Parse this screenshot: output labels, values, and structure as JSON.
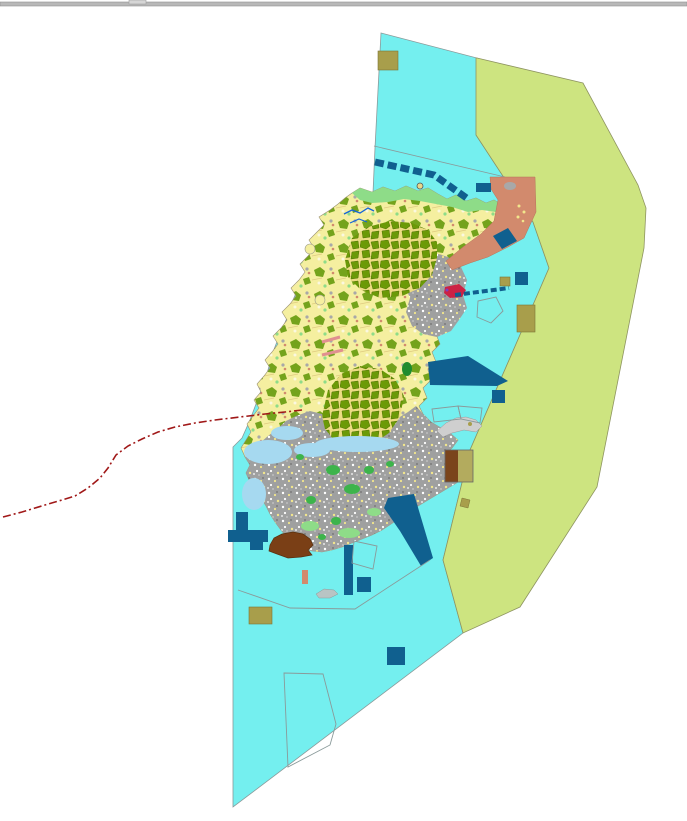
{
  "map": {
    "width": 687,
    "height": 821,
    "background": "#ffffff",
    "palette": {
      "bar": "#b8b8b8",
      "sea": "#74efef",
      "zone": "#cde480",
      "land": "#f5efa0",
      "forest": "#74a31c",
      "forest_dark": "#6b9a07",
      "forest_gap": "#ecdc82",
      "urban": "#9fa0a0",
      "salmon": "#d28a6d",
      "navy": "#10608f",
      "khaki": "#a89e4b",
      "khaki_light": "#b3ab5e",
      "brown": "#7a3f16",
      "brown_dark": "#7a441c",
      "green_light": "#8edc88",
      "green_bright": "#3db44b",
      "green_dark": "#1f8c2f",
      "wetland": "#a6d9f0",
      "redline": "#a01818",
      "river": "#1565d8",
      "outline": "#8a9a9a",
      "crimson": "#cc2244",
      "purple": "#7a3fbf",
      "pink": "#e09090",
      "gray_islet": "#cfcfcf",
      "ship": "#b9c4c4",
      "speck_white": "#fbf8e0",
      "speck_yellow": "#f2e68c",
      "speck_gray": "#a8a8a8"
    },
    "features": [
      {
        "name": "window-top-bar",
        "kind": "rect",
        "x": 0,
        "y": 2,
        "w": 687,
        "h": 4,
        "fill": "bar",
        "stroke": "#8f8f8f",
        "sw": 0.6
      },
      {
        "name": "window-top-bar-notch",
        "kind": "rect",
        "x": 129,
        "y": 0,
        "w": 17,
        "h": 4,
        "fill": "#d6d6d6",
        "stroke": "#9f9f9f",
        "sw": 0.6
      },
      {
        "name": "sea-area",
        "kind": "polygon",
        "pts": "381,33 477,58 476,135 516,196 533,222 549,268 470,450 443,560 463,633 233,807 233,447 242,438 250,420 256,404 262,388 268,370 273,352 280,334 287,318 293,300 300,284 308,268 315,252 322,238 330,224 340,212 352,202 364,196 373,193 375,148",
        "fill": "sea",
        "stroke": "outline",
        "sw": 0.8
      },
      {
        "name": "buffer-zone-area",
        "kind": "polygon",
        "pts": "477,58 583,83 638,185 646,208 644,248 597,487 520,607 463,633 443,560 470,450 549,268 533,222 516,196 476,135 476,58",
        "fill": "zone",
        "stroke": "#8e9460",
        "sw": 0.8
      },
      {
        "name": "sea-boundary-line",
        "kind": "polyline",
        "pts": "374,146 505,177",
        "stroke": "outline",
        "sw": 0.8
      },
      {
        "name": "island-landmass",
        "kind": "polygon",
        "pts": "352,193 360,188 372,192 383,187 395,191 406,186 418,191 428,188 438,194 447,199 456,195 466,201 476,198 486,203 494,200 502,205 510,202 515,208 506,216 496,224 486,231 476,239 466,247 457,256 450,264 455,272 448,280 452,290 444,298 448,308 440,316 444,326 436,334 440,344 432,352 436,362 428,370 431,380 423,388 427,398 419,406 423,414 431,422 441,428 451,434 458,440 452,448 445,454 451,462 461,468 466,474 458,482 448,488 438,494 428,500 418,506 408,512 400,518 391,524 382,530 372,535 362,539 352,543 342,547 332,550 322,552 312,551 302,548 294,543 287,537 281,530 275,522 270,514 266,506 261,498 255,490 250,482 246,473 250,465 245,457 241,448 246,440 251,432 247,424 253,416 259,408 254,400 261,392 257,384 264,376 270,368 265,360 272,352 278,344 273,336 281,328 287,320 282,312 290,304 296,296 291,288 299,280 305,272 300,264 308,256 314,248 309,240 317,232 324,225 319,217 330,210 338,204 345,198",
        "fill": "pattern:sparse",
        "stroke": "#9a9070",
        "sw": 0.6
      },
      {
        "name": "coastal-promontory-north",
        "kind": "circle",
        "cx": 310,
        "cy": 249,
        "r": 5,
        "fill": "land",
        "stroke": "#9a9a8a",
        "sw": 0.6
      },
      {
        "name": "coastal-promontory-west",
        "kind": "circle",
        "cx": 320,
        "cy": 300,
        "r": 5,
        "fill": "land",
        "stroke": "#9a9a8a",
        "sw": 0.6
      },
      {
        "name": "north-coast-strip",
        "kind": "polygon",
        "pts": "352,193 360,188 372,192 383,187 395,191 406,186 418,191 428,188 438,194 447,199 456,195 466,201 476,198 486,203 494,200 502,205 496,212 482,210 468,212 452,207 436,204 420,201 404,199 388,202 372,203 360,200",
        "fill": "green_light"
      },
      {
        "name": "urban-area-east",
        "kind": "polygon",
        "pts": "408,258 428,251 448,257 461,267 467,280 463,295 467,308 459,320 451,331 437,337 423,334 412,326 406,312 410,298 404,284 408,270",
        "fill": "pattern:urban"
      },
      {
        "name": "urban-area-south",
        "kind": "polygon",
        "pts": "296,416 310,411 322,414 334,420 348,427 362,431 376,430 388,425 398,418 408,412 416,406 423,414 431,422 441,428 451,434 458,440 452,448 445,454 451,462 461,468 466,474 458,482 448,488 438,494 428,500 418,506 408,512 400,518 391,524 382,530 372,535 362,539 352,543 342,547 332,550 322,552 312,551 302,548 294,543 287,537 281,530 275,522 270,514 266,506 261,498 255,490 250,482 246,473 250,465 245,457 252,450 260,443 268,436 277,429 286,421",
        "fill": "pattern:urban"
      },
      {
        "name": "forest-cluster-north",
        "kind": "polygon",
        "pts": "345,260 352,238 368,227 390,221 412,223 428,230 437,242 437,258 432,275 420,288 402,296 380,298 361,290 348,277",
        "fill": "pattern:dense"
      },
      {
        "name": "forest-cluster-mid",
        "kind": "polygon",
        "pts": "322,416 328,390 341,374 360,366 380,369 395,379 404,396 400,417 389,433 371,445 351,448 334,440 325,429",
        "fill": "pattern:dense"
      },
      {
        "name": "wetland-west-1",
        "kind": "ellipse",
        "cx": 268,
        "cy": 452,
        "rx": 24,
        "ry": 12,
        "fill": "wetland"
      },
      {
        "name": "wetland-west-2",
        "kind": "ellipse",
        "cx": 254,
        "cy": 494,
        "rx": 12,
        "ry": 16,
        "fill": "wetland"
      },
      {
        "name": "wetland-west-3",
        "kind": "ellipse",
        "cx": 287,
        "cy": 433,
        "rx": 16,
        "ry": 7,
        "fill": "wetland"
      },
      {
        "name": "wetland-south-1",
        "kind": "ellipse",
        "cx": 357,
        "cy": 444,
        "rx": 42,
        "ry": 8,
        "fill": "wetland"
      },
      {
        "name": "wetland-south-2",
        "kind": "ellipse",
        "cx": 312,
        "cy": 450,
        "rx": 18,
        "ry": 7,
        "fill": "wetland"
      },
      {
        "name": "green-patch-1",
        "kind": "ellipse",
        "cx": 333,
        "cy": 470,
        "rx": 7,
        "ry": 5,
        "fill": "green_bright"
      },
      {
        "name": "green-patch-2",
        "kind": "ellipse",
        "cx": 352,
        "cy": 489,
        "rx": 8,
        "ry": 5,
        "fill": "green_bright"
      },
      {
        "name": "green-patch-3",
        "kind": "ellipse",
        "cx": 311,
        "cy": 500,
        "rx": 5,
        "ry": 4,
        "fill": "green_bright"
      },
      {
        "name": "green-patch-4",
        "kind": "ellipse",
        "cx": 369,
        "cy": 470,
        "rx": 5,
        "ry": 4,
        "fill": "green_bright"
      },
      {
        "name": "green-patch-5",
        "kind": "ellipse",
        "cx": 390,
        "cy": 464,
        "rx": 4,
        "ry": 3,
        "fill": "green_bright"
      },
      {
        "name": "green-patch-6",
        "kind": "ellipse",
        "cx": 336,
        "cy": 521,
        "rx": 5,
        "ry": 4,
        "fill": "green_bright"
      },
      {
        "name": "green-patch-7",
        "kind": "ellipse",
        "cx": 322,
        "cy": 537,
        "rx": 4,
        "ry": 3,
        "fill": "green_bright"
      },
      {
        "name": "green-patch-8",
        "kind": "ellipse",
        "cx": 300,
        "cy": 457,
        "rx": 4,
        "ry": 3,
        "fill": "green_bright"
      },
      {
        "name": "green-patch-dark",
        "kind": "ellipse",
        "cx": 407,
        "cy": 369,
        "rx": 5,
        "ry": 7,
        "fill": "green_dark"
      },
      {
        "name": "green-patch-light-1",
        "kind": "ellipse",
        "cx": 310,
        "cy": 526,
        "rx": 9,
        "ry": 5,
        "fill": "green_light"
      },
      {
        "name": "green-patch-light-2",
        "kind": "ellipse",
        "cx": 349,
        "cy": 533,
        "rx": 11,
        "ry": 5,
        "fill": "green_light"
      },
      {
        "name": "green-patch-light-3",
        "kind": "ellipse",
        "cx": 374,
        "cy": 512,
        "rx": 7,
        "ry": 4,
        "fill": "green_light"
      },
      {
        "name": "salmon-area-northeast",
        "kind": "polygon",
        "pts": "490,177 535,177 536,212 524,238 508,247 488,257 470,263 452,270 446,261 463,247 481,234 494,221 498,200 491,189",
        "fill": "salmon",
        "stroke": "#b5745a",
        "sw": 0.5
      },
      {
        "name": "salmon-inner-gray",
        "kind": "ellipse",
        "cx": 510,
        "cy": 186,
        "rx": 6,
        "ry": 4,
        "fill": "speck_gray"
      },
      {
        "name": "salmon-speck-1",
        "kind": "circle",
        "cx": 519,
        "cy": 206,
        "r": 1.5,
        "fill": "speck_yellow"
      },
      {
        "name": "salmon-speck-2",
        "kind": "circle",
        "cx": 524,
        "cy": 212,
        "r": 1.5,
        "fill": "speck_yellow"
      },
      {
        "name": "salmon-speck-3",
        "kind": "circle",
        "cx": 518,
        "cy": 217,
        "r": 1.5,
        "fill": "speck_yellow"
      },
      {
        "name": "salmon-speck-4",
        "kind": "circle",
        "cx": 523,
        "cy": 221,
        "r": 1.3,
        "fill": "speck_yellow"
      },
      {
        "name": "port-entrance-crimson",
        "kind": "polygon",
        "pts": "445,287 459,284 466,290 462,297 450,298 444,293",
        "fill": "crimson"
      },
      {
        "name": "port-entrance-dot-1",
        "kind": "circle",
        "cx": 447,
        "cy": 290,
        "r": 1.5,
        "fill": "purple"
      },
      {
        "name": "port-entrance-dot-2",
        "kind": "circle",
        "cx": 457,
        "cy": 295,
        "r": 1.5,
        "fill": "purple"
      },
      {
        "name": "pink-road-west-1",
        "kind": "polyline",
        "pts": "322,342 340,337",
        "stroke": "pink",
        "sw": 3
      },
      {
        "name": "pink-road-west-2",
        "kind": "polyline",
        "pts": "322,355 343,350",
        "stroke": "pink",
        "sw": 3
      },
      {
        "name": "salmon-blob-south",
        "kind": "rect",
        "x": 302,
        "y": 570,
        "w": 6,
        "h": 14,
        "fill": "salmon"
      },
      {
        "name": "channel-dashed-band",
        "kind": "polyline",
        "pts": "375,162 434,175 468,199",
        "stroke": "navy",
        "sw": 7,
        "dash": "9 4"
      },
      {
        "name": "navy-rect-northeast",
        "kind": "rect",
        "x": 476,
        "y": 183,
        "w": 15,
        "h": 9,
        "fill": "navy"
      },
      {
        "name": "navy-tilted-square",
        "kind": "polygon",
        "pts": "493,236 508,228 517,241 502,249",
        "fill": "navy"
      },
      {
        "name": "navy-square-east",
        "kind": "rect",
        "x": 515,
        "y": 272,
        "w": 13,
        "h": 13,
        "fill": "navy"
      },
      {
        "name": "jetty-dashed-line",
        "kind": "polyline",
        "pts": "455,295 509,288",
        "stroke": "navy",
        "sw": 4,
        "dash": "6 3"
      },
      {
        "name": "harbor-slab-east",
        "kind": "polygon",
        "pts": "428,362 468,356 508,381 497,386 430,385",
        "fill": "navy"
      },
      {
        "name": "navy-square-southeast",
        "kind": "rect",
        "x": 492,
        "y": 390,
        "w": 13,
        "h": 13,
        "fill": "navy"
      },
      {
        "name": "harbor-pier-south",
        "kind": "polygon",
        "pts": "388,498 414,494 433,558 421,566 400,531 384,508",
        "fill": "navy"
      },
      {
        "name": "pier-vertical-south",
        "kind": "rect",
        "x": 344,
        "y": 545,
        "w": 9,
        "h": 50,
        "fill": "navy"
      },
      {
        "name": "navy-square-harbor",
        "kind": "rect",
        "x": 357,
        "y": 577,
        "w": 14,
        "h": 15,
        "fill": "navy"
      },
      {
        "name": "navy-square-bottom",
        "kind": "rect",
        "x": 387,
        "y": 647,
        "w": 18,
        "h": 18,
        "fill": "navy"
      },
      {
        "name": "breakwater-west-1",
        "kind": "rect",
        "x": 236,
        "y": 512,
        "w": 12,
        "h": 20,
        "fill": "navy"
      },
      {
        "name": "breakwater-west-2",
        "kind": "rect",
        "x": 228,
        "y": 530,
        "w": 40,
        "h": 12,
        "fill": "navy"
      },
      {
        "name": "breakwater-west-3",
        "kind": "rect",
        "x": 250,
        "y": 540,
        "w": 13,
        "h": 10,
        "fill": "navy"
      },
      {
        "name": "khaki-square-top",
        "kind": "rect",
        "x": 378,
        "y": 51,
        "w": 20,
        "h": 19,
        "fill": "khaki",
        "stroke": "#7c7436",
        "sw": 0.6
      },
      {
        "name": "khaki-square-east-small",
        "kind": "rect",
        "x": 500,
        "y": 277,
        "w": 10,
        "h": 9,
        "fill": "khaki",
        "stroke": "#7c7436",
        "sw": 0.6
      },
      {
        "name": "khaki-rect-east",
        "kind": "rect",
        "x": 517,
        "y": 305,
        "w": 18,
        "h": 27,
        "fill": "khaki",
        "stroke": "#7c7436",
        "sw": 0.6
      },
      {
        "name": "khaki-rect-bottom",
        "kind": "rect",
        "x": 249,
        "y": 607,
        "w": 23,
        "h": 17,
        "fill": "khaki",
        "stroke": "#7c7436",
        "sw": 0.6
      },
      {
        "name": "khaki-diamond-small",
        "kind": "polygon",
        "pts": "462,498 470,500 468,508 460,506",
        "fill": "khaki",
        "stroke": "#7c7436",
        "sw": 0.5
      },
      {
        "name": "monument-circle-marker",
        "kind": "circle",
        "cx": 420,
        "cy": 186,
        "r": 3,
        "fill": "#e8d88a",
        "stroke": "#555555",
        "sw": 0.8
      },
      {
        "name": "parcel-brown-half",
        "kind": "rect",
        "x": 445,
        "y": 450,
        "w": 13,
        "h": 32,
        "fill": "brown_dark"
      },
      {
        "name": "parcel-khaki-half",
        "kind": "rect",
        "x": 458,
        "y": 450,
        "w": 15,
        "h": 32,
        "fill": "khaki_light"
      },
      {
        "name": "parcel-outline",
        "kind": "rect",
        "x": 445,
        "y": 450,
        "w": 28,
        "h": 32,
        "stroke": "#666666",
        "sw": 0.8
      },
      {
        "name": "brown-landfill-southwest",
        "kind": "polygon",
        "pts": "270,545 274,538 282,534 293,532 303,534 310,539 313,545 308,550 312,555 301,557 288,558 277,554 269,551",
        "fill": "brown",
        "stroke": "#59300f",
        "sw": 0.7
      },
      {
        "name": "islet-gray-southeast",
        "kind": "polygon",
        "pts": "437,431 446,423 456,418 466,417 476,420 482,426 476,432 464,430 452,433 443,437",
        "fill": "gray_islet",
        "stroke": "#9a9a9a",
        "sw": 0.5
      },
      {
        "name": "islet-khaki-dot",
        "kind": "circle",
        "cx": 470,
        "cy": 424,
        "r": 2,
        "fill": "khaki"
      },
      {
        "name": "zone-outline-pentagon",
        "kind": "polygon",
        "pts": "478,301 496,297 503,311 491,323 477,317",
        "stroke": "outline",
        "sw": 0.9
      },
      {
        "name": "zone-outline-quad-1",
        "kind": "polygon",
        "pts": "432,409 458,406 461,419 434,422",
        "stroke": "outline",
        "sw": 0.9
      },
      {
        "name": "zone-outline-quad-2",
        "kind": "polygon",
        "pts": "458,406 482,408 480,423 461,419",
        "stroke": "outline",
        "sw": 0.9
      },
      {
        "name": "zone-outline-bottom",
        "kind": "polygon",
        "pts": "284,673 323,674 336,724 330,745 288,767",
        "stroke": "outline",
        "sw": 0.9
      },
      {
        "name": "zone-outline-harbor-square",
        "kind": "polygon",
        "pts": "354,541 377,546 373,569 352,563",
        "stroke": "outline",
        "sw": 0.9
      },
      {
        "name": "harbor-limit-line",
        "kind": "polyline",
        "pts": "238,590 290,608 355,609 430,560",
        "stroke": "outline",
        "sw": 0.9
      },
      {
        "name": "boundary-dashed-red-line",
        "kind": "path",
        "d": "M3,517 L22,512 L45,505 L62,500 L75,496 L88,488 L100,478 L108,468 L116,455 L128,446 L142,439 L158,432 L175,427 L195,423 L215,420 L240,417 L265,414 L285,412 L302,410",
        "stroke": "redline",
        "sw": 1.6,
        "dash": "8 3 2 3"
      },
      {
        "name": "river-north-1",
        "kind": "polyline",
        "pts": "344,214 352,210 360,213 368,208 374,211",
        "stroke": "river",
        "sw": 1.3
      },
      {
        "name": "river-north-2",
        "kind": "polyline",
        "pts": "350,223 359,219 367,222",
        "stroke": "river",
        "sw": 1.2
      },
      {
        "name": "ship-islet-south",
        "kind": "polygon",
        "pts": "316,594 324,589 334,590 338,594 330,598 319,598",
        "fill": "ship",
        "stroke": "#8a9a9a",
        "sw": 0.5
      }
    ]
  }
}
